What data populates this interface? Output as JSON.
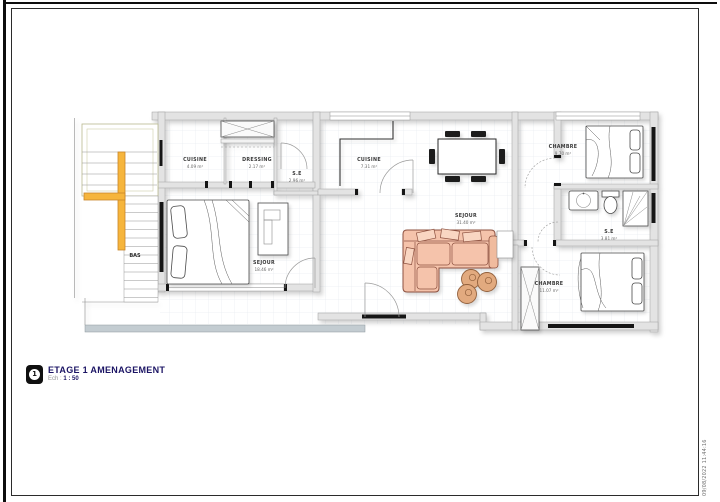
{
  "page": {
    "title": "ETAGE 1 AMENAGEMENT",
    "scale_label": "Ech :",
    "scale_value": "1 : 50",
    "sheet_number": "1",
    "timestamp": "09/08/2022 11:44:16"
  },
  "colors": {
    "accent_yellow": "#f6b53c",
    "accent_yellow_stroke": "#c8862a",
    "sofa_fill": "#f5c3ab",
    "sofa_stroke": "#8d5140",
    "pouf_fill": "#e2aa7f",
    "balcony_gray": "#c3ccd1",
    "title_navy": "#1b1464",
    "wall_gray": "#e3e3e3"
  },
  "rooms": [
    {
      "name": "CUISINE",
      "area": "4.09 m²"
    },
    {
      "name": "DRESSING",
      "area": "2.17 m²"
    },
    {
      "name": "S.E",
      "area": "2.96 m²"
    },
    {
      "name": "SEJOUR",
      "area": "18.46 m²"
    },
    {
      "name": "CUISINE",
      "area": "7.31 m²"
    },
    {
      "name": "SEJOUR",
      "area": "31.40 m²"
    },
    {
      "name": "CHAMBRE",
      "area": "9.70 m²"
    },
    {
      "name": "S.E",
      "area": "3.81 m²"
    },
    {
      "name": "CHAMBRE",
      "area": "11.07 m²"
    }
  ],
  "stairs": {
    "label": "BAS"
  }
}
